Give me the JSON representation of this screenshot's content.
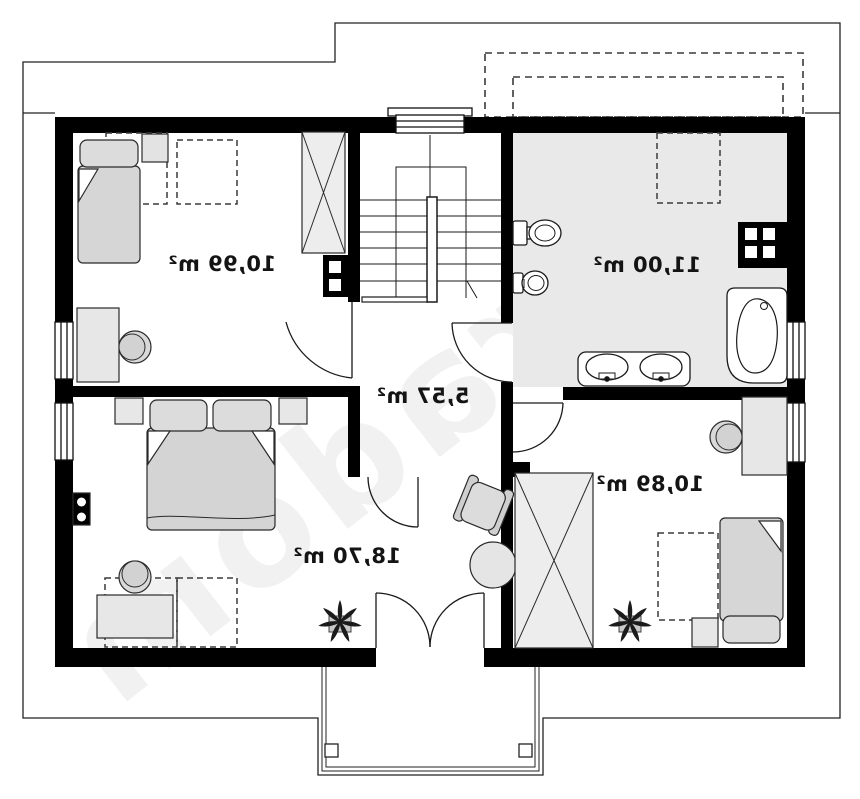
{
  "watermark": "extradom",
  "rooms": [
    {
      "id": "bedroom-top-left",
      "area_label": "10,99 m²"
    },
    {
      "id": "bathroom",
      "area_label": "11,00 m²"
    },
    {
      "id": "hall",
      "area_label": "5,57 m²"
    },
    {
      "id": "bedroom-main",
      "area_label": "18,70 m²"
    },
    {
      "id": "bedroom-right",
      "area_label": "10,89 m²"
    }
  ],
  "colors": {
    "wall": "#000000",
    "bathroom_floor": "#e9e9e9",
    "furniture_fill": "#d9d9d9",
    "line": "#1a1a1a"
  }
}
